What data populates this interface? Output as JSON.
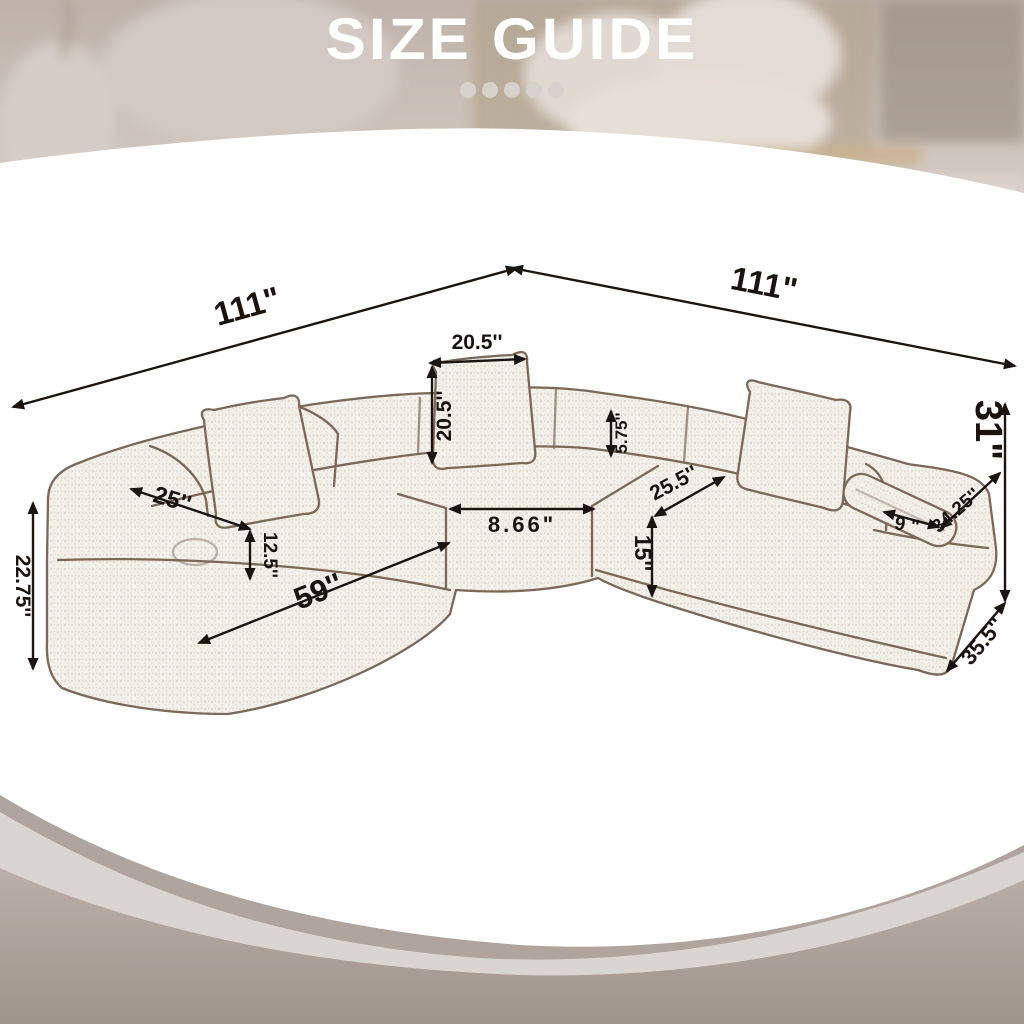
{
  "header": {
    "title": "SIZE GUIDE",
    "dots_count": 5
  },
  "diagram": {
    "labels": {
      "total_width_left": "111\"",
      "total_width_right": "111\"",
      "back_pillow_width": "20.5''",
      "back_pillow_height": "20.5''",
      "back_rest_height": "5.75''",
      "overall_height": "31\"",
      "left_seat_width": "25''",
      "seat_cushion_height": "12.5''",
      "left_arm_height": "22.75''",
      "left_module_length": "59''",
      "center_seat_width": "8.66\"",
      "corner_seat_depth": "25.5''",
      "right_seat_height": "15''",
      "armrest_width": "9 \"",
      "armrest_depth": "34.25''",
      "right_module_depth": "35.5''"
    },
    "colors": {
      "dimension_ink": "#1a1511",
      "sketch_outline": "#7b6858",
      "upholstery": "#f3efe9",
      "background_taupe": "#b2a7a0",
      "card_white": "#ffffff",
      "title_color": "#ffffff"
    }
  }
}
